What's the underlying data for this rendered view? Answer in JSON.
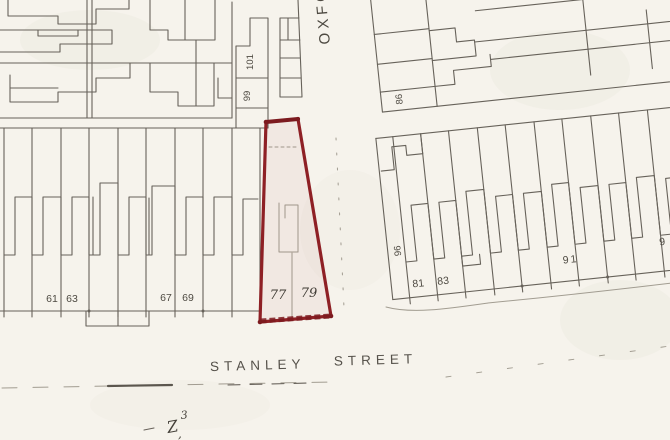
{
  "map": {
    "streets": {
      "vertical_street": "OXFO",
      "horizontal_street_word1": "STANLEY",
      "horizontal_street_word2": "STREET"
    },
    "house_numbers": {
      "block_top_left": {
        "n101": "101",
        "n99": "99"
      },
      "block_left_row": {
        "n61": "61",
        "n63": "63",
        "n67": "67",
        "n69": "69"
      },
      "plot_highlighted": {
        "n77": "77",
        "n79": "79"
      },
      "block_right_upper": {
        "n86": "86"
      },
      "block_right_lower": {
        "n96": "96",
        "n81": "81",
        "n83": "83",
        "n91": "91",
        "n9_partial": "9"
      }
    },
    "pencil_annotations": {
      "mark_z": "Z",
      "mark_3": "3",
      "mark_comma": ","
    },
    "colors": {
      "paper": "#f6f3ec",
      "pencil": "#5b564e",
      "pencil_light": "#938d81",
      "label_ink": "#4e4a42",
      "plot_red": "#8e2025",
      "plot_red_dark": "#7c1a1f"
    }
  }
}
